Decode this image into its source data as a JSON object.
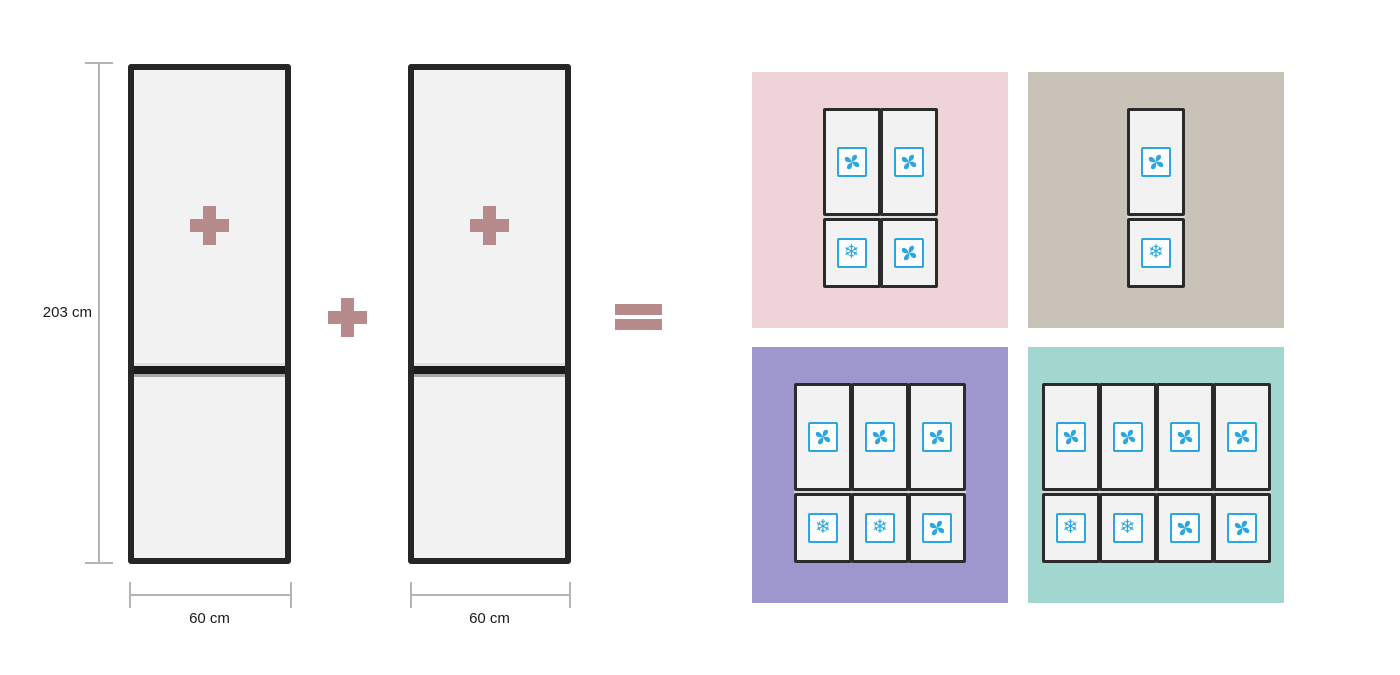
{
  "left_panel": {
    "height_label": "203 cm",
    "fridge_1": {
      "width_label": "60 cm",
      "badge_icon": "plus-icon"
    },
    "fridge_2": {
      "width_label": "60 cm",
      "badge_icon": "plus-icon"
    },
    "operators": {
      "between_fridges": "plus",
      "before_result": "equals"
    }
  },
  "icons": {
    "fan": "fan-icon",
    "snowflake": "snowflake-icon",
    "snowflake_glyph": "❄"
  },
  "tiles": [
    {
      "name": "result-two-column-combo",
      "bg": "#eed4d9",
      "columns": 2,
      "top_icons": [
        "fan",
        "fan"
      ],
      "bottom_icons": [
        "snowflake",
        "fan"
      ]
    },
    {
      "name": "result-single-column",
      "bg": "#c8c2b8",
      "columns": 1,
      "top_icons": [
        "fan"
      ],
      "bottom_icons": [
        "snowflake"
      ]
    },
    {
      "name": "result-three-column-combo",
      "bg": "#9d97cd",
      "columns": 3,
      "top_icons": [
        "fan",
        "fan",
        "fan"
      ],
      "bottom_icons": [
        "snowflake",
        "snowflake",
        "fan"
      ]
    },
    {
      "name": "result-four-column-combo",
      "bg": "#a2d7d0",
      "columns": 4,
      "top_icons": [
        "fan",
        "fan",
        "fan",
        "fan"
      ],
      "bottom_icons": [
        "snowflake",
        "snowflake",
        "fan",
        "fan"
      ]
    }
  ],
  "colors": {
    "accent_rose": "#b78b8b",
    "icon_blue": "#29a8e0",
    "fridge_fill": "#f2f2f2",
    "fridge_border": "#262626",
    "dimension_line": "#b5b5b5",
    "tile_pink": "#eed4d9",
    "tile_taupe": "#c8c2b8",
    "tile_purple": "#9d97cd",
    "tile_teal": "#a2d7d0"
  }
}
